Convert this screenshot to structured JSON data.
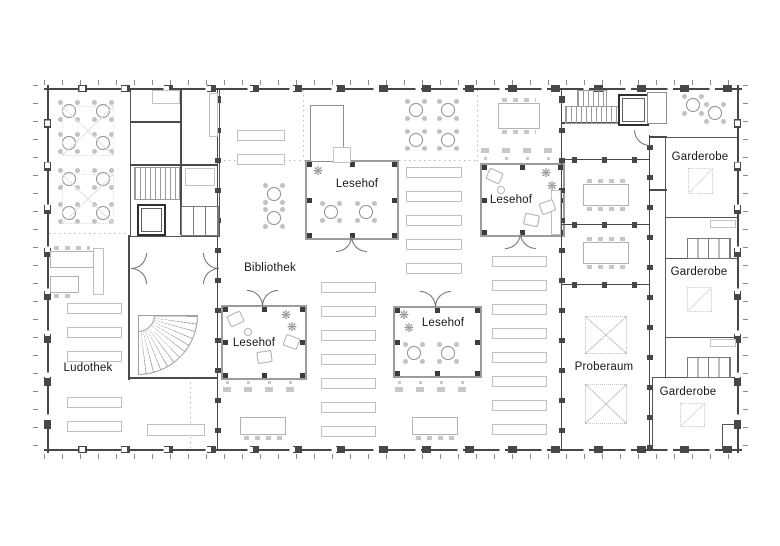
{
  "rooms": {
    "ludothek": "Ludothek",
    "bibliothek": "Bibliothek",
    "lesehof_top": "Lesehof",
    "lesehof_upper_right": "Lesehof",
    "lesehof_lower_left": "Lesehof",
    "lesehof_lower_mid": "Lesehof",
    "proberaum": "Proberaum",
    "garderobe_top": "Garderobe",
    "garderobe_mid": "Garderobe",
    "garderobe_bottom": "Garderobe"
  },
  "icons": {
    "plant": "❋"
  },
  "colors": {
    "wall": "#474747",
    "courtyard_wall": "#9c9c9c",
    "furniture_light": "#c3c3c3",
    "text": "#161616",
    "background": "#ffffff"
  }
}
